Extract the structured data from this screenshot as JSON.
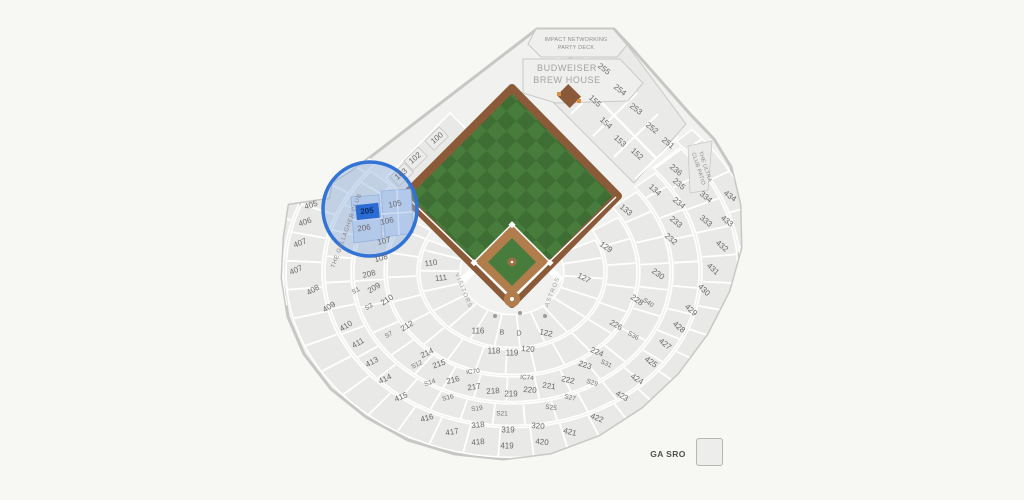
{
  "legend": {
    "label": "GA SRO"
  },
  "landmarks": {
    "party_deck_line1": "IMPACT NETWORKING",
    "party_deck_line2": "PARTY DECK",
    "brew_house_line1": "BUDWEISER",
    "brew_house_line2": "BREW HOUSE",
    "gallagher_club": "THE GALLAGHER CLUB",
    "ultra_club_line1": "THE ULTRA",
    "ultra_club_line2": "CLUB PATIO",
    "visitors_dugout": "VISITORS",
    "astros_dugout": "ASTROS"
  },
  "highlight": {
    "selected_section": "205"
  },
  "colors": {
    "highlight_blue": "#3273d6",
    "highlight_fill": "rgba(140,173,224,0.42)",
    "selected_fill": "#2a6bd4",
    "field_green": "#477c3c",
    "field_green_dark": "#3e6e34",
    "dirt_brown": "#b17d4d",
    "track_brown": "#8a5a39",
    "section_fill": "#e9e9e7",
    "outline_gray": "#c7c7c5"
  },
  "map": {
    "sections": [
      {
        "label": "100",
        "x": 437,
        "y": 138,
        "rot": -40
      },
      {
        "label": "102",
        "x": 415,
        "y": 158,
        "rot": -40
      },
      {
        "label": "103",
        "x": 401,
        "y": 174,
        "rot": -38
      },
      {
        "label": "105",
        "x": 395,
        "y": 204,
        "rot": -12
      },
      {
        "label": "106",
        "x": 387,
        "y": 221,
        "rot": -12
      },
      {
        "label": "107",
        "x": 384,
        "y": 241,
        "rot": -14
      },
      {
        "label": "108",
        "x": 381,
        "y": 258,
        "rot": -16
      },
      {
        "label": "110",
        "x": 431,
        "y": 263,
        "rot": -8
      },
      {
        "label": "111",
        "x": 441,
        "y": 278,
        "rot": -6
      },
      {
        "label": "116",
        "x": 478,
        "y": 331,
        "rot": 0
      },
      {
        "label": "118",
        "x": 494,
        "y": 351,
        "rot": 0
      },
      {
        "label": "119",
        "x": 512,
        "y": 353,
        "rot": 0
      },
      {
        "label": "120",
        "x": 528,
        "y": 349,
        "rot": 4
      },
      {
        "label": "122",
        "x": 546,
        "y": 333,
        "rot": 12
      },
      {
        "label": "127",
        "x": 584,
        "y": 278,
        "rot": 28
      },
      {
        "label": "129",
        "x": 606,
        "y": 247,
        "rot": 34
      },
      {
        "label": "133",
        "x": 626,
        "y": 210,
        "rot": 40
      },
      {
        "label": "134",
        "x": 655,
        "y": 190,
        "rot": 42
      },
      {
        "label": "152",
        "x": 637,
        "y": 154,
        "rot": 42
      },
      {
        "label": "153",
        "x": 620,
        "y": 141,
        "rot": 42
      },
      {
        "label": "154",
        "x": 606,
        "y": 123,
        "rot": 42
      },
      {
        "label": "155",
        "x": 595,
        "y": 101,
        "rot": 42
      },
      {
        "label": "205",
        "x": 367,
        "y": 211,
        "rot": -6,
        "cls": "sel"
      },
      {
        "label": "206",
        "x": 364,
        "y": 228,
        "rot": -8
      },
      {
        "label": "208",
        "x": 369,
        "y": 274,
        "rot": -14
      },
      {
        "label": "209",
        "x": 374,
        "y": 288,
        "rot": -32
      },
      {
        "label": "210",
        "x": 387,
        "y": 300,
        "rot": -34
      },
      {
        "label": "212",
        "x": 407,
        "y": 326,
        "rot": -32
      },
      {
        "label": "214",
        "x": 427,
        "y": 353,
        "rot": -26
      },
      {
        "label": "215",
        "x": 439,
        "y": 364,
        "rot": -20
      },
      {
        "label": "216",
        "x": 453,
        "y": 380,
        "rot": -14
      },
      {
        "label": "217",
        "x": 474,
        "y": 387,
        "rot": -8
      },
      {
        "label": "218",
        "x": 493,
        "y": 391,
        "rot": -4
      },
      {
        "label": "219",
        "x": 511,
        "y": 394,
        "rot": 0
      },
      {
        "label": "220",
        "x": 530,
        "y": 390,
        "rot": 5
      },
      {
        "label": "221",
        "x": 549,
        "y": 386,
        "rot": 8
      },
      {
        "label": "222",
        "x": 568,
        "y": 380,
        "rot": 12
      },
      {
        "label": "223",
        "x": 585,
        "y": 365,
        "rot": 18
      },
      {
        "label": "224",
        "x": 597,
        "y": 352,
        "rot": 24
      },
      {
        "label": "226",
        "x": 616,
        "y": 325,
        "rot": 30
      },
      {
        "label": "228",
        "x": 637,
        "y": 300,
        "rot": 34
      },
      {
        "label": "230",
        "x": 658,
        "y": 274,
        "rot": 36
      },
      {
        "label": "232",
        "x": 671,
        "y": 239,
        "rot": 40
      },
      {
        "label": "233",
        "x": 676,
        "y": 222,
        "rot": 40
      },
      {
        "label": "234",
        "x": 679,
        "y": 203,
        "rot": 40
      },
      {
        "label": "235",
        "x": 679,
        "y": 184,
        "rot": 40
      },
      {
        "label": "236",
        "x": 676,
        "y": 170,
        "rot": 40
      },
      {
        "label": "251",
        "x": 668,
        "y": 143,
        "rot": 38
      },
      {
        "label": "252",
        "x": 652,
        "y": 128,
        "rot": 38
      },
      {
        "label": "253",
        "x": 636,
        "y": 109,
        "rot": 38
      },
      {
        "label": "254",
        "x": 620,
        "y": 90,
        "rot": 38
      },
      {
        "label": "255",
        "x": 604,
        "y": 69,
        "rot": 38
      },
      {
        "label": "318",
        "x": 478,
        "y": 425,
        "rot": -5
      },
      {
        "label": "319",
        "x": 508,
        "y": 430,
        "rot": 0
      },
      {
        "label": "320",
        "x": 538,
        "y": 426,
        "rot": 5
      },
      {
        "label": "333",
        "x": 706,
        "y": 221,
        "rot": 40
      },
      {
        "label": "334",
        "x": 706,
        "y": 197,
        "rot": 40
      },
      {
        "label": "405",
        "x": 311,
        "y": 205,
        "rot": -18
      },
      {
        "label": "406",
        "x": 305,
        "y": 222,
        "rot": -20
      },
      {
        "label": "407",
        "x": 300,
        "y": 243,
        "rot": -22
      },
      {
        "label": "407",
        "x": 296,
        "y": 270,
        "rot": -24
      },
      {
        "label": "408",
        "x": 313,
        "y": 290,
        "rot": -30
      },
      {
        "label": "409",
        "x": 329,
        "y": 307,
        "rot": -32
      },
      {
        "label": "410",
        "x": 346,
        "y": 326,
        "rot": -32
      },
      {
        "label": "411",
        "x": 358,
        "y": 343,
        "rot": -30
      },
      {
        "label": "413",
        "x": 372,
        "y": 362,
        "rot": -28
      },
      {
        "label": "414",
        "x": 385,
        "y": 379,
        "rot": -26
      },
      {
        "label": "415",
        "x": 401,
        "y": 397,
        "rot": -22
      },
      {
        "label": "416",
        "x": 427,
        "y": 418,
        "rot": -15
      },
      {
        "label": "417",
        "x": 452,
        "y": 432,
        "rot": -10
      },
      {
        "label": "418",
        "x": 478,
        "y": 442,
        "rot": -5
      },
      {
        "label": "419",
        "x": 507,
        "y": 446,
        "rot": 0
      },
      {
        "label": "420",
        "x": 542,
        "y": 442,
        "rot": 6
      },
      {
        "label": "421",
        "x": 570,
        "y": 432,
        "rot": 14
      },
      {
        "label": "422",
        "x": 597,
        "y": 418,
        "rot": 22
      },
      {
        "label": "423",
        "x": 622,
        "y": 396,
        "rot": 30
      },
      {
        "label": "424",
        "x": 637,
        "y": 379,
        "rot": 33
      },
      {
        "label": "425",
        "x": 651,
        "y": 362,
        "rot": 35
      },
      {
        "label": "427",
        "x": 665,
        "y": 344,
        "rot": 38
      },
      {
        "label": "428",
        "x": 679,
        "y": 327,
        "rot": 40
      },
      {
        "label": "429",
        "x": 691,
        "y": 310,
        "rot": 42
      },
      {
        "label": "430",
        "x": 704,
        "y": 290,
        "rot": 44
      },
      {
        "label": "431",
        "x": 713,
        "y": 269,
        "rot": 42
      },
      {
        "label": "432",
        "x": 722,
        "y": 246,
        "rot": 40
      },
      {
        "label": "433",
        "x": 727,
        "y": 221,
        "rot": 38
      },
      {
        "label": "434",
        "x": 730,
        "y": 196,
        "rot": 36
      },
      {
        "label": "S1",
        "x": 356,
        "y": 291,
        "rot": -30,
        "cls": "s"
      },
      {
        "label": "S3",
        "x": 369,
        "y": 307,
        "rot": -32,
        "cls": "s"
      },
      {
        "label": "S7",
        "x": 389,
        "y": 335,
        "rot": -30,
        "cls": "s"
      },
      {
        "label": "S12",
        "x": 417,
        "y": 365,
        "rot": -26,
        "cls": "s"
      },
      {
        "label": "S14",
        "x": 430,
        "y": 383,
        "rot": -20,
        "cls": "s"
      },
      {
        "label": "S16",
        "x": 448,
        "y": 398,
        "rot": -14,
        "cls": "s"
      },
      {
        "label": "S19",
        "x": 477,
        "y": 409,
        "rot": -8,
        "cls": "s"
      },
      {
        "label": "S21",
        "x": 502,
        "y": 414,
        "rot": 0,
        "cls": "s"
      },
      {
        "label": "S25",
        "x": 551,
        "y": 408,
        "rot": 8,
        "cls": "s"
      },
      {
        "label": "S27",
        "x": 570,
        "y": 398,
        "rot": 14,
        "cls": "s"
      },
      {
        "label": "S29",
        "x": 592,
        "y": 383,
        "rot": 18,
        "cls": "s"
      },
      {
        "label": "S31",
        "x": 606,
        "y": 364,
        "rot": 24,
        "cls": "s"
      },
      {
        "label": "S36",
        "x": 633,
        "y": 336,
        "rot": 30,
        "cls": "s"
      },
      {
        "label": "S40",
        "x": 648,
        "y": 303,
        "rot": 34,
        "cls": "s"
      },
      {
        "label": "IC70",
        "x": 473,
        "y": 372,
        "rot": -6,
        "cls": "s"
      },
      {
        "label": "IC74",
        "x": 527,
        "y": 378,
        "rot": 4,
        "cls": "s"
      },
      {
        "label": "B",
        "x": 502,
        "y": 333,
        "rot": 0,
        "cls": "ltr"
      },
      {
        "label": "D",
        "x": 519,
        "y": 334,
        "rot": 0,
        "cls": "ltr"
      }
    ]
  }
}
